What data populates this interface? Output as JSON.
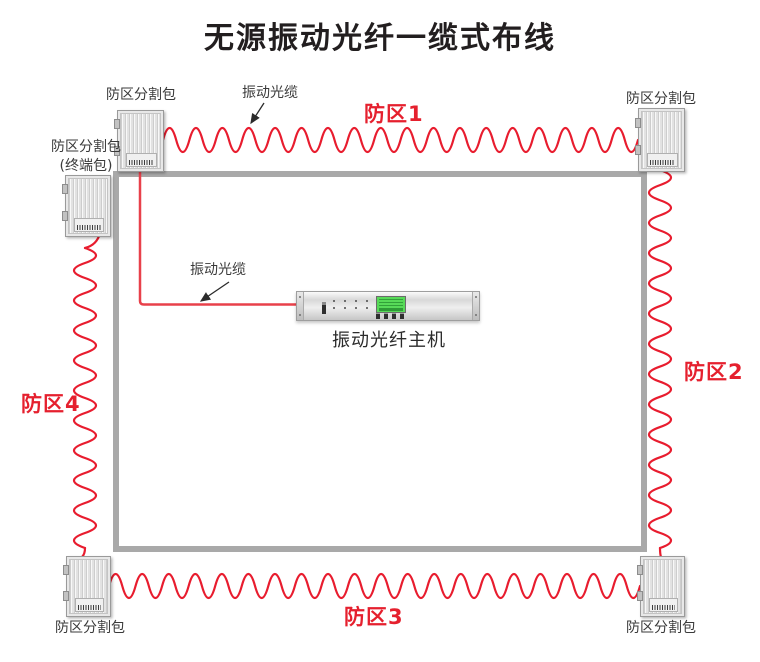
{
  "title": "无源振动光纤一缆式布线",
  "cable_labels": {
    "top": "振动光缆",
    "host_feed": "振动光缆"
  },
  "host": {
    "label": "振动光纤主机"
  },
  "boxes": {
    "top_left": {
      "label": "防区分割包"
    },
    "top_right": {
      "label": "防区分割包"
    },
    "terminal": {
      "label": "防区分割包",
      "sublabel": "(终端包)"
    },
    "bottom_left": {
      "label": "防区分割包"
    },
    "bottom_right": {
      "label": "防区分割包"
    }
  },
  "zones": {
    "zone1": "防区1",
    "zone2": "防区2",
    "zone3": "防区3",
    "zone4": "防区4"
  },
  "colors": {
    "cable_red": "#e81c2e",
    "zone_label_red": "#e5202e",
    "wall_gray": "#a9a9a9",
    "title_color": "#221e1f",
    "label_color": "#3a3a3a",
    "lcd_green": "#57da58"
  }
}
